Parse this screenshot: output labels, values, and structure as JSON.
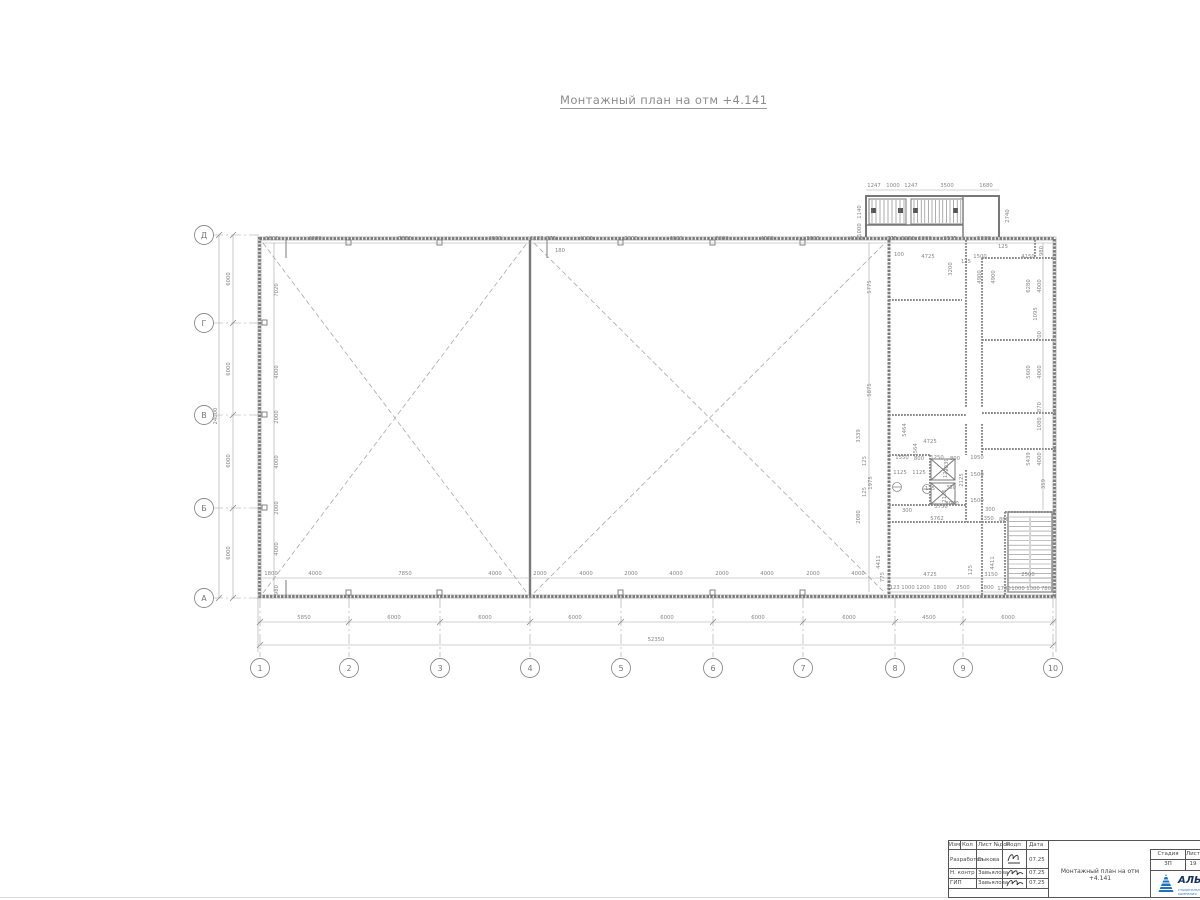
{
  "title": "Монтажный план на отм +4.141",
  "colors": {
    "wall": "#787878",
    "line": "#a3a3a3",
    "dim": "#8a8a8a",
    "dark": "#4a4a4a",
    "logo_blue": "#1e73be"
  },
  "plan": {
    "axes_bottom": [
      {
        "label": "1",
        "x": 260
      },
      {
        "label": "2",
        "x": 349
      },
      {
        "label": "3",
        "x": 440
      },
      {
        "label": "4",
        "x": 530
      },
      {
        "label": "5",
        "x": 621
      },
      {
        "label": "6",
        "x": 713
      },
      {
        "label": "7",
        "x": 803
      },
      {
        "label": "8",
        "x": 895
      },
      {
        "label": "9",
        "x": 963
      },
      {
        "label": "10",
        "x": 1053
      }
    ],
    "axes_left": [
      {
        "label": "Д",
        "y": 235
      },
      {
        "label": "Г",
        "y": 323
      },
      {
        "label": "В",
        "y": 415
      },
      {
        "label": "Б",
        "y": 508
      },
      {
        "label": "А",
        "y": 598
      }
    ],
    "dim_labels": [
      [
        874,
        187,
        "1247"
      ],
      [
        893,
        187,
        "1000"
      ],
      [
        911,
        187,
        "1247"
      ],
      [
        947,
        187,
        "3500"
      ],
      [
        986,
        187,
        "1680"
      ],
      [
        861,
        212,
        "1140",
        1
      ],
      [
        861,
        230,
        "1000",
        1
      ],
      [
        1009,
        216,
        "2740",
        1
      ],
      [
        272,
        240,
        "1800"
      ],
      [
        315,
        240,
        "4000"
      ],
      [
        405,
        240,
        "7850"
      ],
      [
        495,
        240,
        "4000"
      ],
      [
        537,
        240,
        "1125"
      ],
      [
        551,
        240,
        "775"
      ],
      [
        586,
        240,
        "4000"
      ],
      [
        631,
        240,
        "2000"
      ],
      [
        676,
        240,
        "4000"
      ],
      [
        722,
        240,
        "2000"
      ],
      [
        767,
        240,
        "4000"
      ],
      [
        813,
        240,
        "2000"
      ],
      [
        856,
        240,
        "4000"
      ],
      [
        892,
        240,
        "775"
      ],
      [
        908,
        240,
        "1150"
      ],
      [
        925,
        240,
        "1000"
      ],
      [
        950,
        240,
        "2575"
      ],
      [
        984,
        240,
        "1380"
      ],
      [
        560,
        252,
        "180"
      ],
      [
        1003,
        248,
        "125"
      ],
      [
        1043,
        251,
        "980",
        1
      ],
      [
        899,
        256,
        "100"
      ],
      [
        928,
        258,
        "4725"
      ],
      [
        952,
        269,
        "3200",
        1
      ],
      [
        966,
        263,
        "125"
      ],
      [
        980,
        258,
        "1500"
      ],
      [
        1028,
        258,
        "4150"
      ],
      [
        981,
        277,
        "4900",
        1
      ],
      [
        995,
        277,
        "4900",
        1
      ],
      [
        1030,
        286,
        "6280",
        1
      ],
      [
        1041,
        286,
        "4000",
        1
      ],
      [
        1037,
        314,
        "1095",
        1
      ],
      [
        1041,
        336,
        "700",
        1
      ],
      [
        1030,
        372,
        "5600",
        1
      ],
      [
        1041,
        372,
        "4000",
        1
      ],
      [
        1041,
        407,
        "870",
        1
      ],
      [
        1041,
        424,
        "1080",
        1
      ],
      [
        1030,
        459,
        "5439",
        1
      ],
      [
        1041,
        459,
        "4000",
        1
      ],
      [
        1045,
        484,
        "359",
        1
      ],
      [
        871,
        287,
        "5775",
        1
      ],
      [
        871,
        390,
        "5875",
        1
      ],
      [
        860,
        436,
        "3339",
        1
      ],
      [
        866,
        461,
        "125",
        1
      ],
      [
        872,
        483,
        "1975",
        1
      ],
      [
        866,
        492,
        "125",
        1
      ],
      [
        860,
        517,
        "2080",
        1
      ],
      [
        880,
        562,
        "4411",
        1
      ],
      [
        884,
        577,
        "775",
        1
      ],
      [
        906,
        430,
        "5464",
        1
      ],
      [
        917,
        450,
        "5564",
        1
      ],
      [
        930,
        443,
        "4725"
      ],
      [
        902,
        459,
        "1550"
      ],
      [
        919,
        460,
        "800"
      ],
      [
        937,
        459,
        "1250"
      ],
      [
        955,
        460,
        "800"
      ],
      [
        977,
        459,
        "1950"
      ],
      [
        948,
        465,
        "2039",
        1
      ],
      [
        900,
        474,
        "1125"
      ],
      [
        919,
        474,
        "1125"
      ],
      [
        947,
        473,
        "125",
        1
      ],
      [
        963,
        480,
        "2125",
        1
      ],
      [
        977,
        476,
        "1500"
      ],
      [
        930,
        490,
        "125"
      ],
      [
        946,
        496,
        "2125",
        1
      ],
      [
        977,
        502,
        "1500"
      ],
      [
        951,
        489,
        "350"
      ],
      [
        941,
        508,
        "3750"
      ],
      [
        907,
        512,
        "300"
      ],
      [
        952,
        505,
        "8000"
      ],
      [
        990,
        511,
        "300"
      ],
      [
        937,
        520,
        "5762"
      ],
      [
        987,
        520,
        "1350"
      ],
      [
        1004,
        521,
        "880"
      ],
      [
        271,
        575,
        "1800"
      ],
      [
        315,
        575,
        "4000"
      ],
      [
        405,
        575,
        "7850"
      ],
      [
        495,
        575,
        "4000"
      ],
      [
        540,
        575,
        "2000"
      ],
      [
        586,
        575,
        "4000"
      ],
      [
        631,
        575,
        "2000"
      ],
      [
        676,
        575,
        "4000"
      ],
      [
        722,
        575,
        "2000"
      ],
      [
        767,
        575,
        "4000"
      ],
      [
        813,
        575,
        "2000"
      ],
      [
        858,
        575,
        "4000"
      ],
      [
        930,
        576,
        "4725"
      ],
      [
        972,
        570,
        "125",
        1
      ],
      [
        991,
        576,
        "3150"
      ],
      [
        1028,
        576,
        "2500"
      ],
      [
        278,
        590,
        "980",
        1
      ],
      [
        994,
        563,
        "4411",
        1
      ],
      [
        893,
        589,
        "1123"
      ],
      [
        908,
        589,
        "1000"
      ],
      [
        923,
        589,
        "1200"
      ],
      [
        940,
        589,
        "1800"
      ],
      [
        963,
        589,
        "2500"
      ],
      [
        987,
        589,
        "1800"
      ],
      [
        1004,
        590,
        "1700"
      ],
      [
        1018,
        590,
        "1000"
      ],
      [
        1033,
        590,
        "1000"
      ],
      [
        1046,
        590,
        "780"
      ],
      [
        278,
        290,
        "7020",
        1
      ],
      [
        278,
        372,
        "4000",
        1
      ],
      [
        278,
        417,
        "2000",
        1
      ],
      [
        278,
        462,
        "4000",
        1
      ],
      [
        278,
        508,
        "2000",
        1
      ],
      [
        278,
        549,
        "4000",
        1
      ],
      [
        230,
        279,
        "6000",
        1
      ],
      [
        230,
        369,
        "6000",
        1
      ],
      [
        230,
        461,
        "6000",
        1
      ],
      [
        230,
        553,
        "6000",
        1
      ],
      [
        217,
        416,
        "24000",
        1
      ],
      [
        304,
        619,
        "5850"
      ],
      [
        394,
        619,
        "6000"
      ],
      [
        485,
        619,
        "6000"
      ],
      [
        575,
        619,
        "6000"
      ],
      [
        667,
        619,
        "6000"
      ],
      [
        758,
        619,
        "6000"
      ],
      [
        849,
        619,
        "6000"
      ],
      [
        929,
        619,
        "4500"
      ],
      [
        1008,
        619,
        "6000"
      ],
      [
        656,
        641,
        "52350"
      ]
    ]
  },
  "titleblock": {
    "header": [
      "Изм",
      "Кол",
      "Лист №док",
      "Подп",
      "Дата"
    ],
    "rows": [
      {
        "role": "Разработал",
        "name": "Быкова",
        "date": "07.25"
      },
      {
        "role": "Н. контр",
        "name": "Завьялова",
        "date": "07.25"
      },
      {
        "role": "ГИП",
        "name": "Завьялова",
        "date": "07.25"
      }
    ],
    "doc_title": "Монтажный план на отм +4.141",
    "stage_label": "Стадия",
    "stage": "ЗП",
    "sheet_label": "Лист",
    "sheet": "19",
    "logo_text": "АЛЬЯНС",
    "logo_sub": "строительная компания"
  }
}
